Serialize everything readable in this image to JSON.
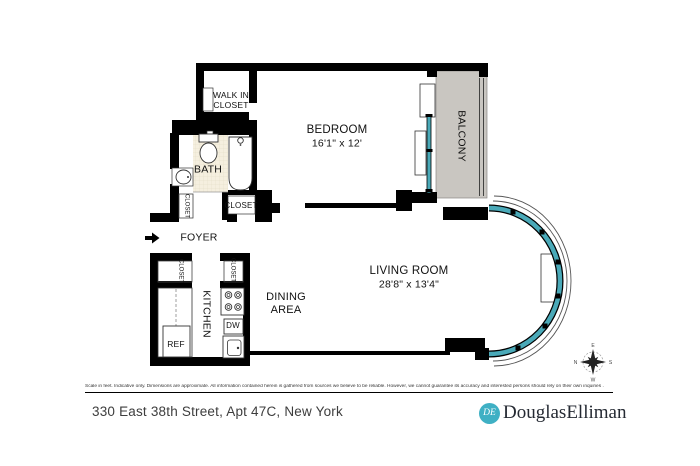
{
  "plan": {
    "labels": {
      "walk_in_closet": "WALK IN\nCLOSET",
      "bedroom": "BEDROOM",
      "bedroom_dims": "16'1\" x 12'",
      "balcony": "BALCONY",
      "bath": "BATH",
      "closet": "CLOSET",
      "foyer": "FOYER",
      "kitchen": "KITCHEN",
      "dining_area": "DINING\nAREA",
      "living_room": "LIVING ROOM",
      "living_room_dims": "28'8\" x 13'4\"",
      "ref": "REF",
      "dw": "DW"
    },
    "compass": {
      "n": "N",
      "s": "S",
      "e": "E",
      "w": "W"
    },
    "colors": {
      "wall": "#000000",
      "glass": "#4aa9b8",
      "balcony_fill": "#c9c6c1",
      "tile_fill": "#f5efdf"
    }
  },
  "footer": {
    "disclaimer": "Scale in feet. Indicative only. Dimensions are approximate. All information contained herein is gathered from sources we believe to be reliable. However, we cannot guarantee its accuracy and interested persons should rely on their own inquiries .",
    "address": "330 East 38th Street, Apt 47C, New York",
    "brand": "DouglasElliman",
    "brand_monogram": "DE"
  }
}
